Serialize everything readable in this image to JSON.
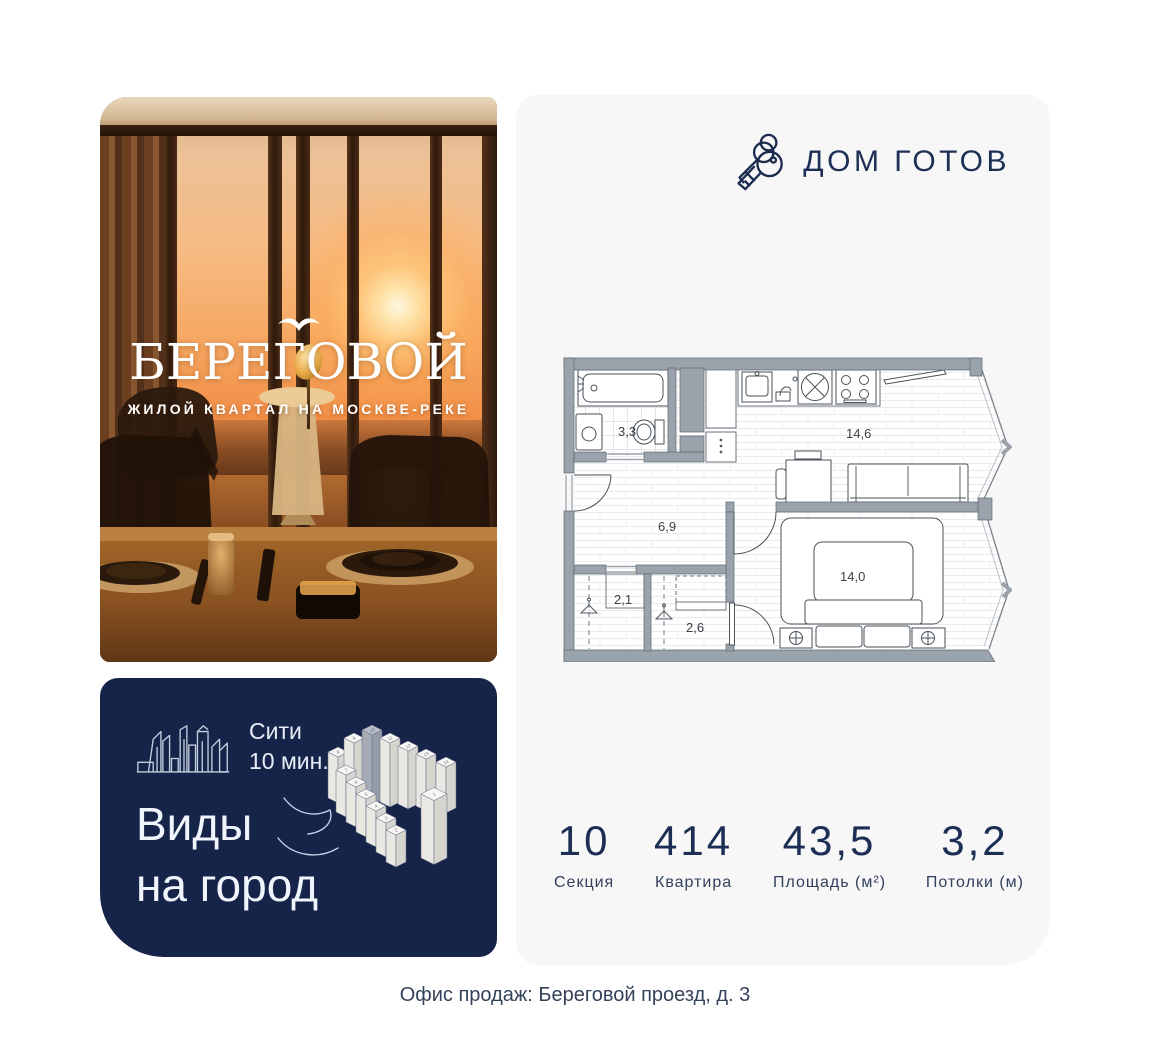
{
  "brand": {
    "title": "БЕРЕГОВОЙ",
    "subtitle": "ЖИЛОЙ КВАРТАЛ НА МОСКВЕ-РЕКЕ"
  },
  "promo": {
    "metro_line1": "Сити",
    "metro_line2": "10 мин.",
    "headline_line1": "Виды",
    "headline_line2": "на город",
    "tower_numbers": [
      "1",
      "2",
      "3",
      "4",
      "5",
      "6",
      "7",
      "8",
      "9",
      "10",
      "11",
      "12",
      "13",
      "14"
    ]
  },
  "plan": {
    "status": "ДОМ ГОТОВ",
    "areas": {
      "bathroom": "3,3",
      "kitchen_living": "14,6",
      "hallway": "6,9",
      "wardrobe_small": "2,1",
      "wardrobe_large": "2,6",
      "bedroom": "14,0"
    },
    "stats": [
      {
        "value": "10",
        "label": "Секция"
      },
      {
        "value": "414",
        "label": "Квартира"
      },
      {
        "value": "43,5",
        "label": "Площадь (м²)"
      },
      {
        "value": "3,2",
        "label": "Потолки (м)"
      }
    ]
  },
  "footer": {
    "address": "Офис продаж: Береговой проезд, д. 3"
  },
  "colors": {
    "navy": "#1d2f55",
    "promo_bg": "#162449",
    "card_bg": "#f7f7f8",
    "wall_gray": "#9aa2ab"
  }
}
